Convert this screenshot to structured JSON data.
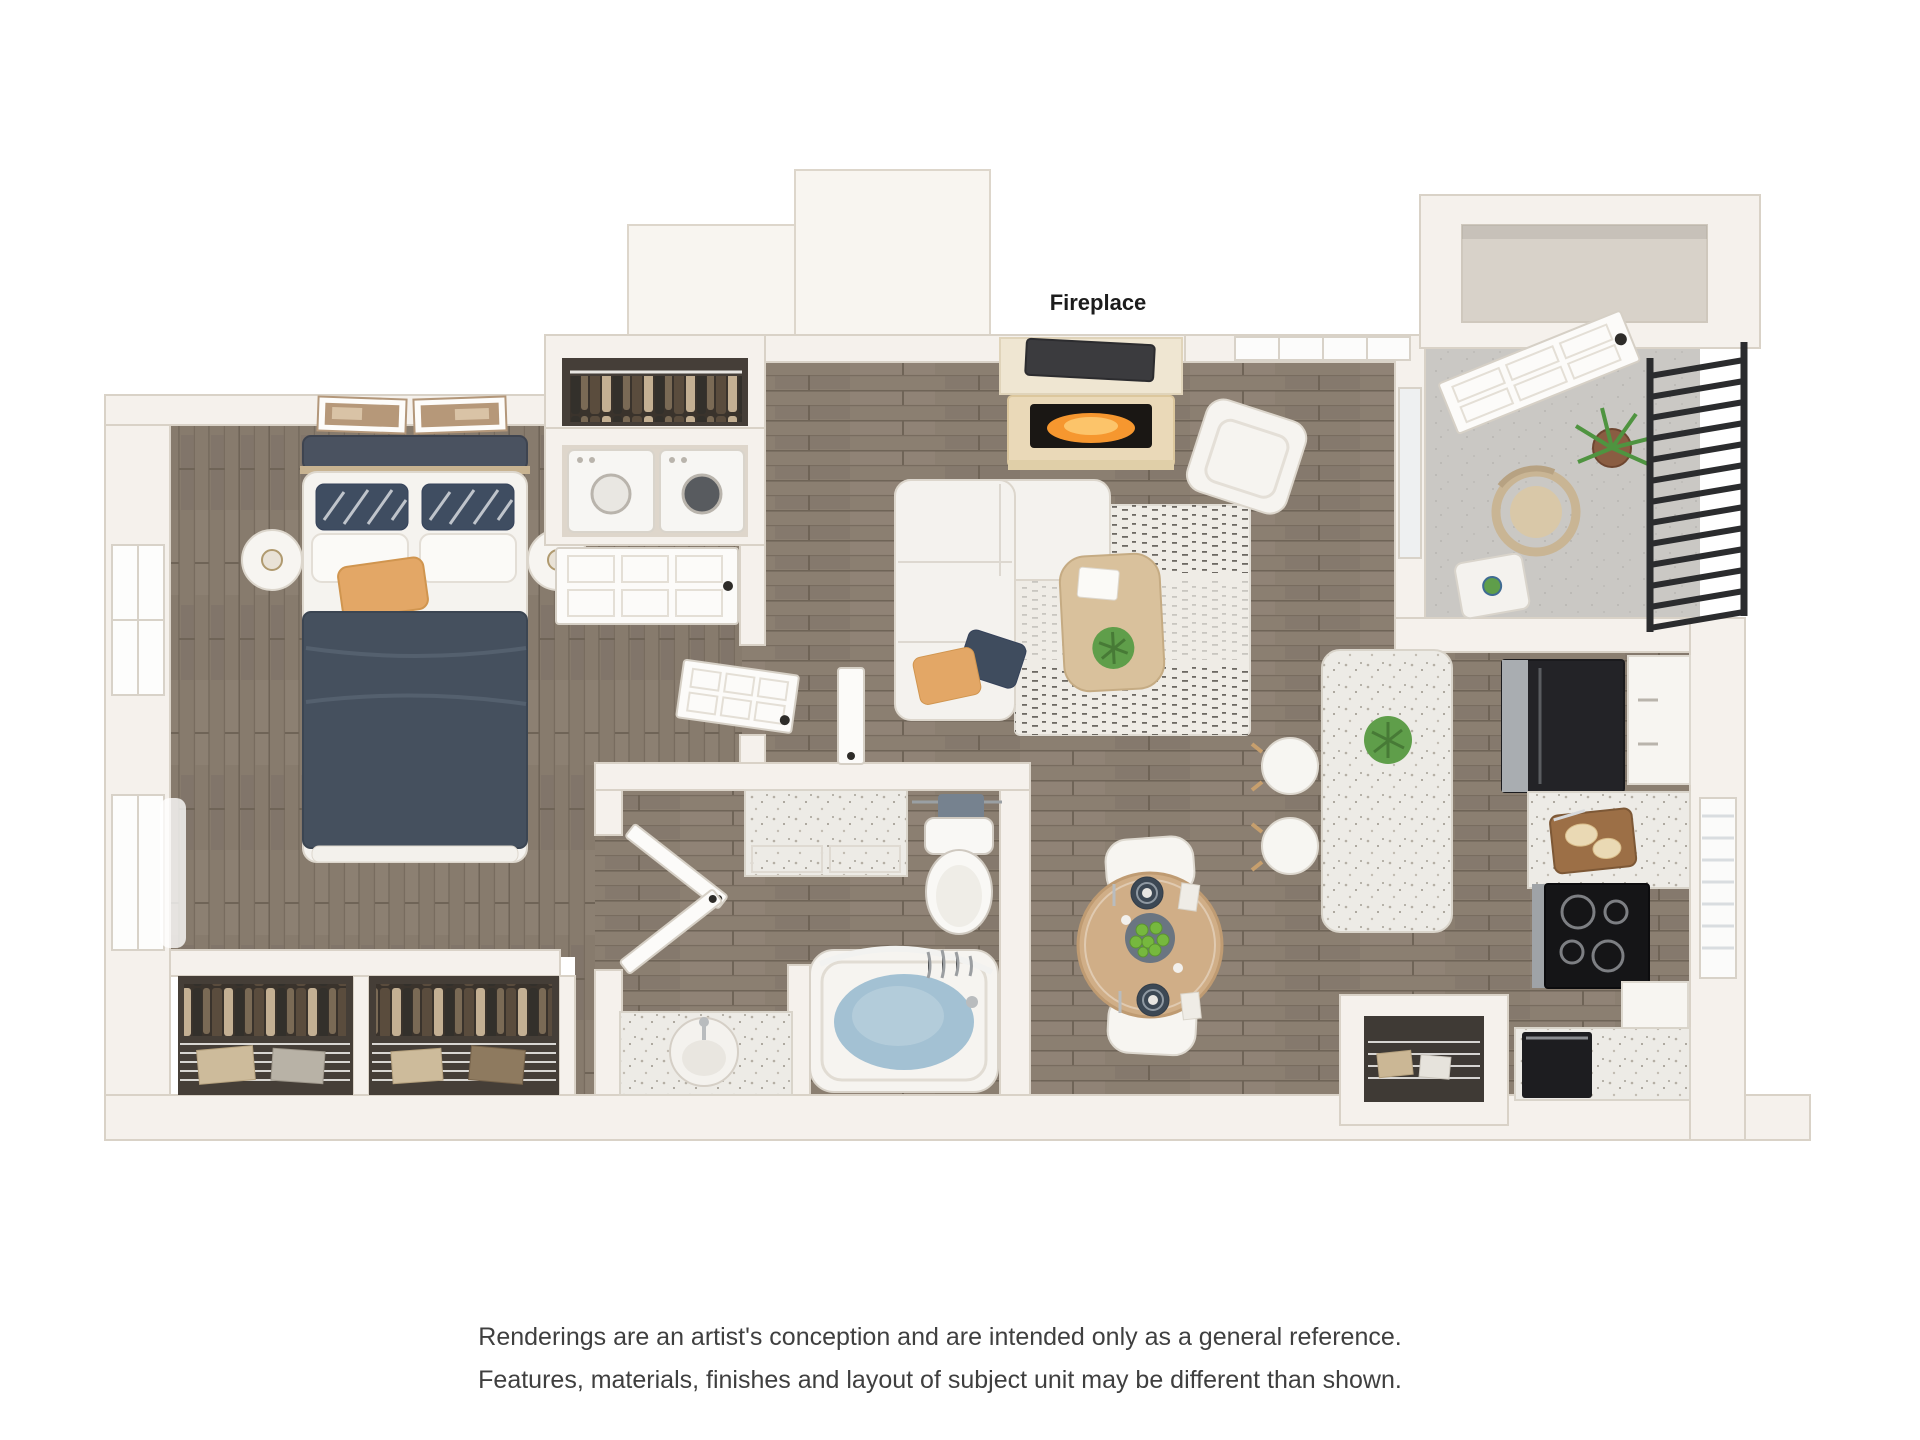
{
  "labels": {
    "fireplace": "Fireplace"
  },
  "disclaimer": {
    "line1": "Renderings are an artist's conception and are intended only as a general reference.",
    "line2": "Features, materials, finishes and layout of subject unit may be different than shown."
  },
  "colors": {
    "wall": "#f5f1ec",
    "wood_floor": "#8b7f71",
    "balcony_floor": "#cac8c4",
    "counter_speckle": "#edebe6",
    "bed_blanket": "#45505e",
    "accent_pillow": "#e3a766",
    "hearth": "#ead9b8",
    "fire": "#f6972f",
    "tv": "#3b3b3e",
    "sofa": "#f4f2ee",
    "rug": "#efece6",
    "coffee_table": "#d9c19c",
    "plant_green": "#5f9e4a",
    "dining_table": "#d0ae87",
    "plate_navy": "#3e4a57",
    "fruit_green": "#76b83e",
    "fridge": "#232327",
    "stove": "#151517",
    "tub_water": "#a3c1d3",
    "towel": "#76828f",
    "railing": "#2b2c2e",
    "disclaimer_text": "#3f3f3f"
  }
}
